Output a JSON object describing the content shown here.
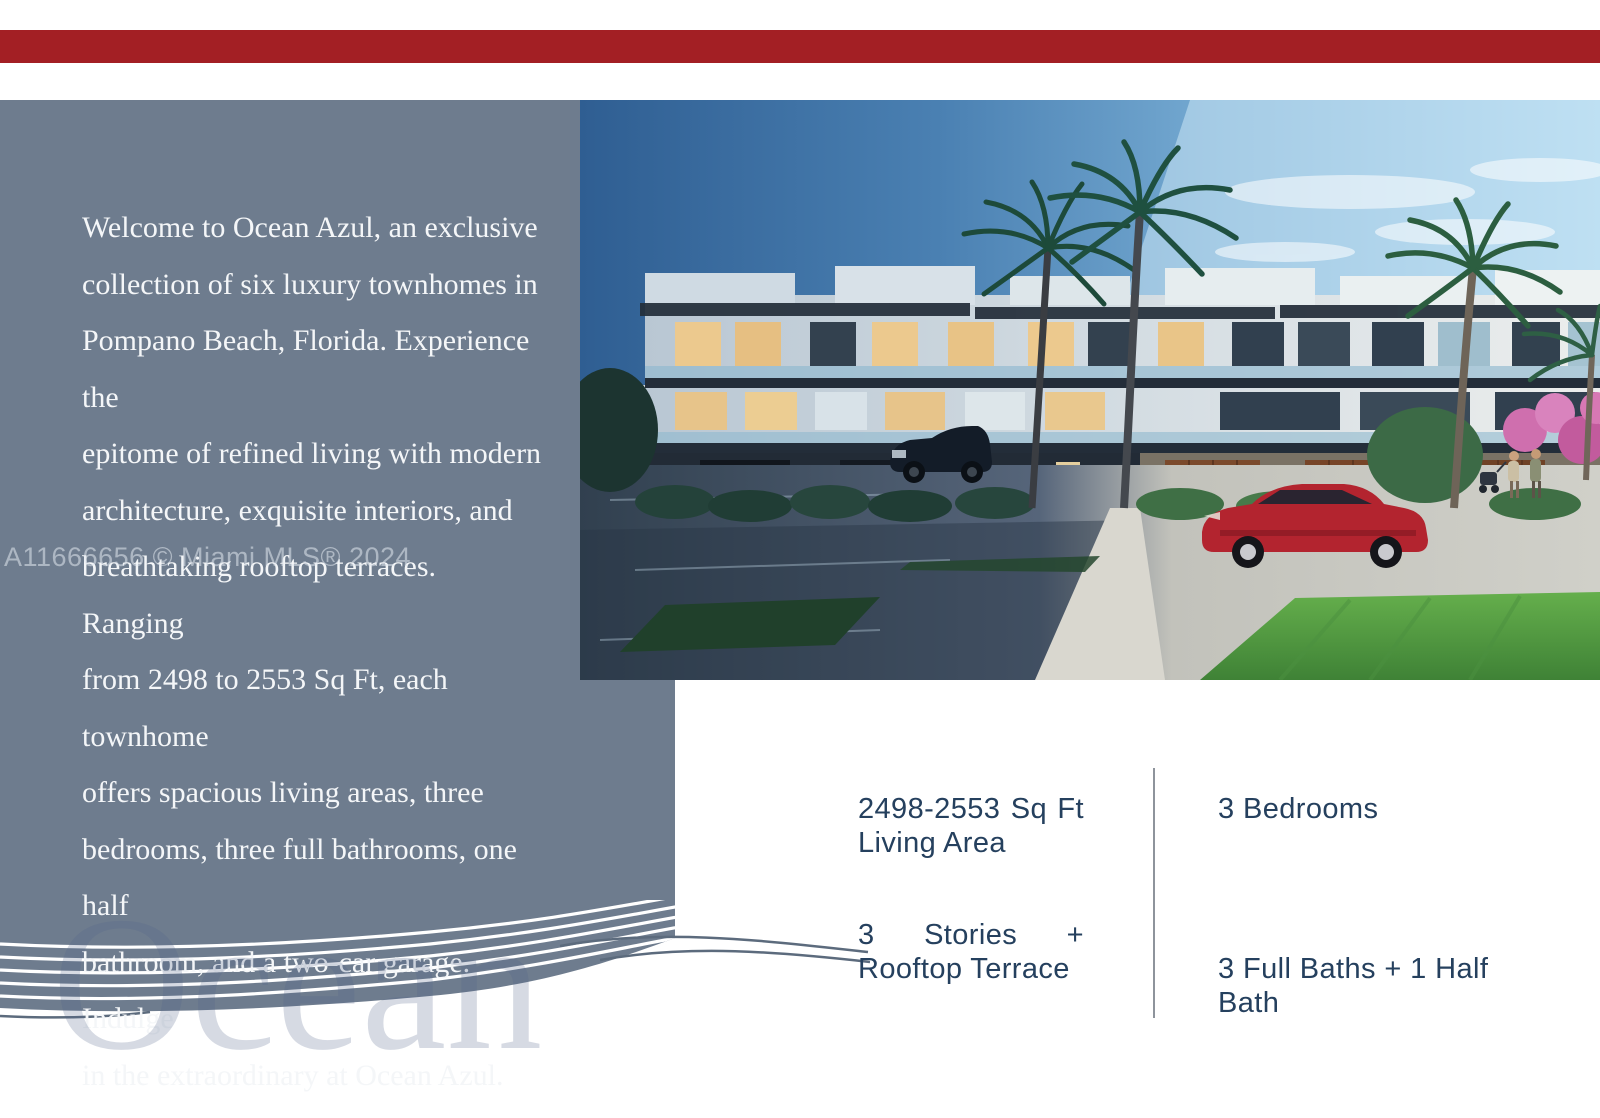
{
  "colors": {
    "accent_bar": "#a31f24",
    "panel": "#6e7c8e",
    "stats_text": "#25405e",
    "paragraph_text": "#f4f6f8"
  },
  "description": {
    "text": "Welcome to Ocean Azul, an exclusive\ncollection of six luxury townhomes in\nPompano Beach, Florida. Experience the\nepitome of refined living with modern\narchitecture, exquisite interiors, and\nbreathtaking rooftop terraces. Ranging\nfrom 2498 to 2553 Sq Ft, each townhome\noffers spacious living areas, three\nbedrooms, three full bathrooms, one half\nbathroom, and a two-car garage. Indulge\nin the extraordinary at Ocean Azul."
  },
  "watermarks": {
    "listing": "A11666656 © Miami MLS® 2024",
    "ocean": "Ocean"
  },
  "features": {
    "living_area": {
      "value": "2498-2553",
      "unit_word1": "Sq",
      "unit_word2": "Ft",
      "line2": "Living Area"
    },
    "bedrooms": {
      "label": "3 Bedrooms"
    },
    "stories": {
      "count": "3",
      "word": "Stories",
      "plus": "+",
      "line2": "Rooftop Terrace"
    },
    "baths": {
      "label": "3 Full Baths + 1 Half\nBath"
    }
  }
}
